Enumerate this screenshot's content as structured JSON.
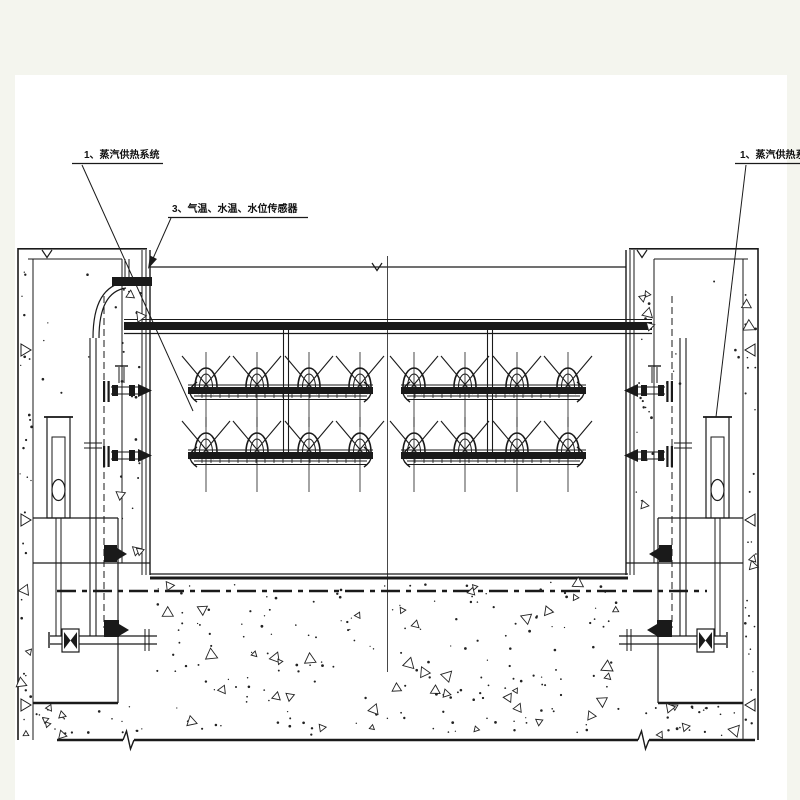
{
  "colors": {
    "page_margin": "#f4f5ee",
    "paper": "#ffffff",
    "ink": "#1a1a1a",
    "ink_soft": "#333333"
  },
  "labels": {
    "left_steam_system": "1、蒸汽供热系统",
    "sensors": "3、气温、水温、水位传感器",
    "right_steam_system": "1、蒸汽供热系统"
  }
}
